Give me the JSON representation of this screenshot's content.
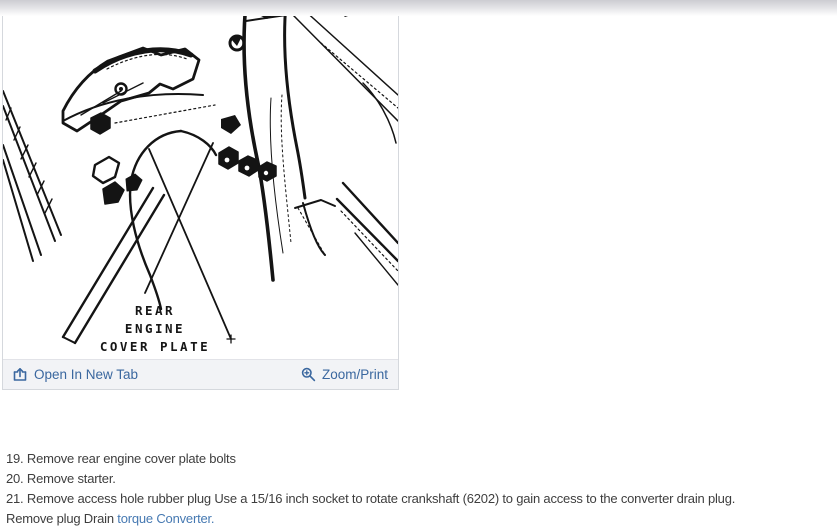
{
  "figure": {
    "label": {
      "line1": "REAR",
      "line2": "ENGINE",
      "line3": "COVER PLATE"
    },
    "toolbar": {
      "open_in_new_tab_label": "Open In New Tab",
      "zoom_print_label": "Zoom/Print",
      "icons": {
        "left": "open-in-new-tab-icon",
        "right": "magnifier-zoom-plus-icon"
      }
    }
  },
  "steps": {
    "step19": "19. Remove rear engine cover plate bolts",
    "step20": "20. Remove starter.",
    "step21": "21. Remove access hole rubber plug Use a 15/16 inch socket to rotate crankshaft (6202) to gain access to the converter drain plug.",
    "step22_prefix": "Remove plug Drain ",
    "step22_link": "torque Converter."
  },
  "colors": {
    "toolbar_link_blue": "#3a679f",
    "step_link_blue": "#4679b2",
    "body_text": "#3e3e3e",
    "toolbar_bg": "#f2f3f6",
    "panel_border": "#d5d8dd",
    "top_bar_gray": "#cdcdd2",
    "drawing_ink": "#141414"
  }
}
